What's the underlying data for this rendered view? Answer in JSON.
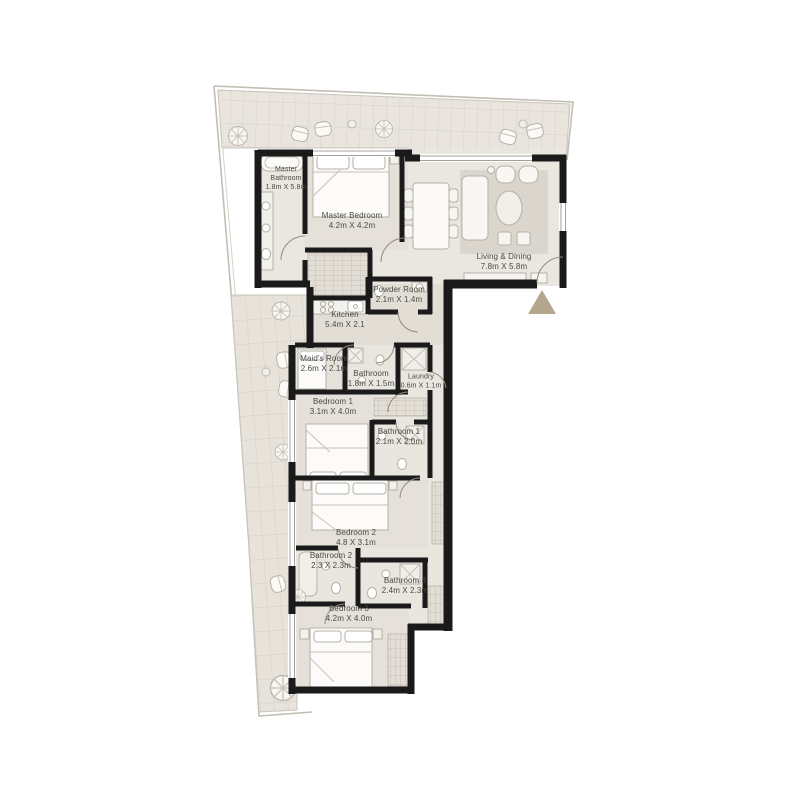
{
  "plan": {
    "wall_color": "#1a1a1a",
    "entrance_marker_color": "#b5a78e",
    "floor_color": "#eae7e1",
    "balcony_tile_color": "#e9e5de",
    "rooms": [
      {
        "id": "master-bathroom",
        "name": "Master Bathroom",
        "dims": "1.8m X 5.8m"
      },
      {
        "id": "master-bedroom",
        "name": "Master Bedroom",
        "dims": "4.2m X 4.2m"
      },
      {
        "id": "living-dining",
        "name": "Living & Dining",
        "dims": "7.8m X 5.8m"
      },
      {
        "id": "powder-room",
        "name": "Powder Room",
        "dims": "2.1m X 1.4m"
      },
      {
        "id": "kitchen",
        "name": "Kitchen",
        "dims": "5.4m X 2.1"
      },
      {
        "id": "maids-room",
        "name": "Maid's Room",
        "dims": "2.6m X 2.1m"
      },
      {
        "id": "bathroom",
        "name": "Bathroom",
        "dims": "1.8m X 1.5m"
      },
      {
        "id": "laundry",
        "name": "Laundry",
        "dims": "0.6m X 1.1m"
      },
      {
        "id": "bedroom-1",
        "name": "Bedroom 1",
        "dims": "3.1m X 4.0m"
      },
      {
        "id": "bathroom-1",
        "name": "Bathroom 1",
        "dims": "2.1m X 2.0m"
      },
      {
        "id": "bedroom-2",
        "name": "Bedroom 2",
        "dims": "4.8 X 3.1m"
      },
      {
        "id": "bathroom-2",
        "name": "Bathroom 2",
        "dims": "2.3 X 2.3m"
      },
      {
        "id": "bathroom-3",
        "name": "Bathroom 3",
        "dims": "2.4m X 2.3m"
      },
      {
        "id": "bedroom-3",
        "name": "Bedroom 3",
        "dims": "4.2m X 4.0m"
      }
    ]
  }
}
